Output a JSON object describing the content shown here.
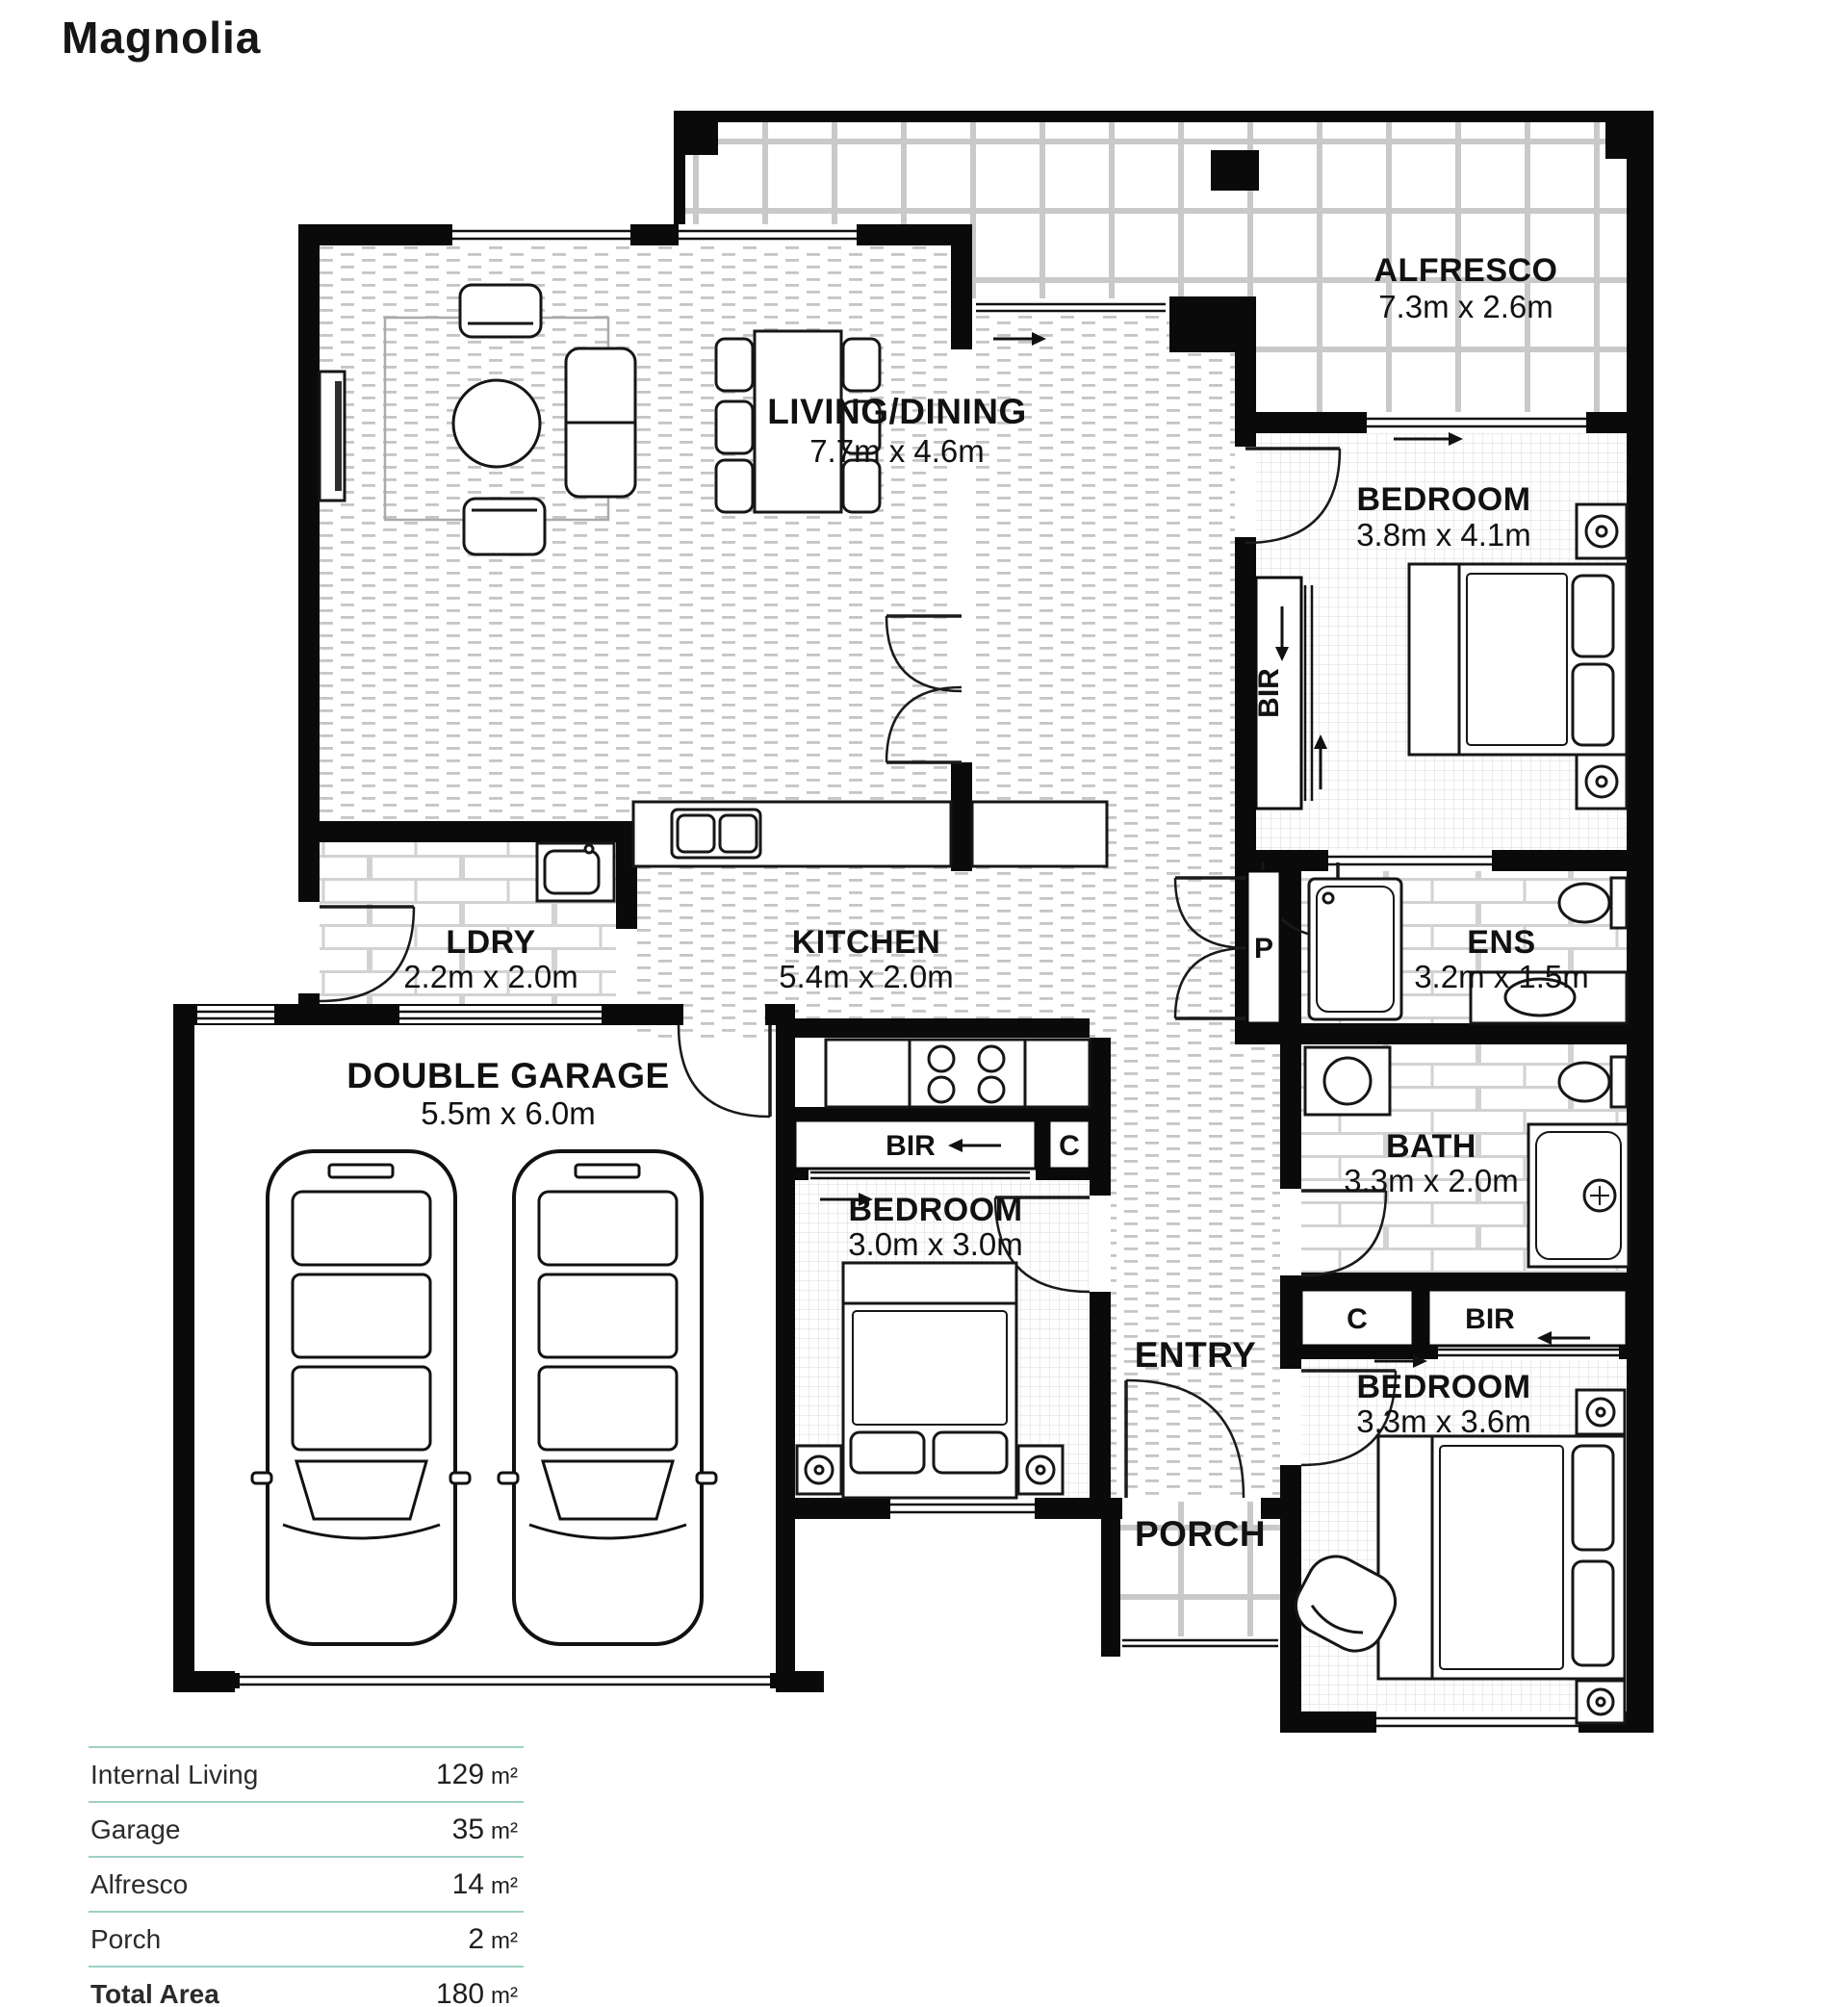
{
  "title": "Magnolia",
  "rooms": {
    "alfresco": {
      "name": "ALFRESCO",
      "dims": "7.3m x 2.6m"
    },
    "living_dining": {
      "name": "LIVING/DINING",
      "dims": "7.7m x 4.6m"
    },
    "bedroom_master": {
      "name": "BEDROOM",
      "dims": "3.8m x 4.1m"
    },
    "laundry": {
      "name": "LDRY",
      "dims": "2.2m x 2.0m"
    },
    "kitchen": {
      "name": "KITCHEN",
      "dims": "5.4m x 2.0m"
    },
    "ensuite": {
      "name": "ENS",
      "dims": "3.2m x 1.5m"
    },
    "garage": {
      "name": "DOUBLE GARAGE",
      "dims": "5.5m x 6.0m"
    },
    "bedroom_two": {
      "name": "BEDROOM",
      "dims": "3.0m x 3.0m"
    },
    "bathroom": {
      "name": "BATH",
      "dims": "3.3m x 2.0m"
    },
    "bedroom_three": {
      "name": "BEDROOM",
      "dims": "3.3m x 3.6m"
    },
    "entry": {
      "name": "ENTRY"
    },
    "porch": {
      "name": "PORCH"
    }
  },
  "closets": {
    "bir_master": "BIR",
    "pantry": "P",
    "bir_hall": "BIR",
    "cupboard_hall": "C",
    "cupboard_bed3": "C",
    "bir_bed3": "BIR"
  },
  "area_table": {
    "rows": [
      {
        "label": "Internal Living",
        "value": "129",
        "unit": "m²"
      },
      {
        "label": "Garage",
        "value": "35",
        "unit": "m²"
      },
      {
        "label": "Alfresco",
        "value": "14",
        "unit": "m²"
      },
      {
        "label": "Porch",
        "value": "2",
        "unit": "m²"
      },
      {
        "label": "Total Area",
        "value": "180",
        "unit": "m²"
      }
    ]
  },
  "colors": {
    "accent_line": "#9ed0c6",
    "wall": "#0a0a0a",
    "label": "#111111"
  }
}
